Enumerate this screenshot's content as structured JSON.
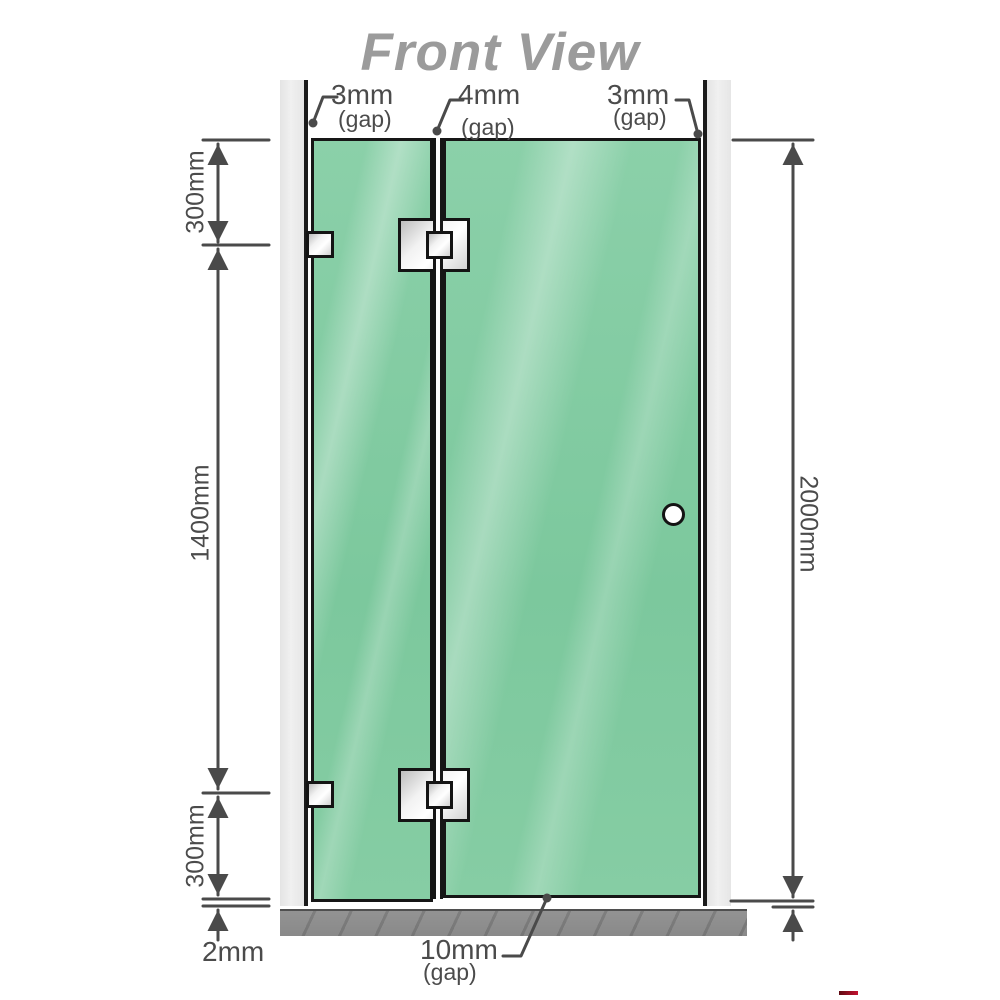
{
  "title": "Front View",
  "top_labels": {
    "left": {
      "value": "3mm",
      "note": "(gap)"
    },
    "middle": {
      "value": "4mm",
      "note": "(gap)"
    },
    "right": {
      "value": "3mm",
      "note": "(gap)"
    }
  },
  "bottom_label": {
    "value": "10mm",
    "note": "(gap)"
  },
  "dimensions": {
    "left_top": "300mm",
    "left_middle": "1400mm",
    "left_bottom": "300mm",
    "floor_gap": "2mm",
    "right_total": "2000mm"
  },
  "colors": {
    "glass_green": "#84cba2",
    "wall_grey": "#ebebeb",
    "floor_grey": "#8d8d8d",
    "line_grey": "#4a4a4a",
    "title_grey": "#9b9b9b",
    "hardware_silver": "#e8e8e8",
    "watermark_red": "#c41230"
  }
}
